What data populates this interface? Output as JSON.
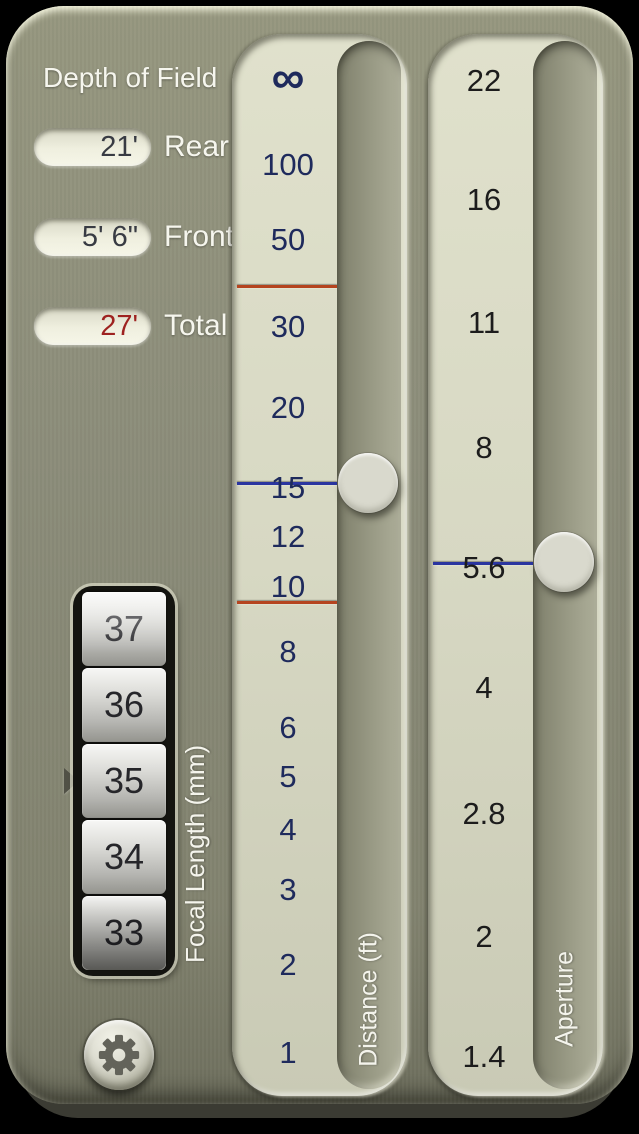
{
  "app": {
    "title": "Depth of Field"
  },
  "readouts": {
    "rear": {
      "value": "21'",
      "label": "Rear"
    },
    "front": {
      "value": "5' 6\"",
      "label": "Front"
    },
    "total": {
      "value": "27'",
      "label": "Total"
    }
  },
  "focal_picker": {
    "label": "Focal Length (mm)",
    "selected": "35",
    "values": [
      {
        "text": "37"
      },
      {
        "text": "36"
      },
      {
        "text": "35"
      },
      {
        "text": "34"
      },
      {
        "text": "33"
      }
    ]
  },
  "distance_slider": {
    "label": "Distance (ft)",
    "ticks": [
      {
        "text": "∞",
        "y": 43,
        "cls": "inf"
      },
      {
        "text": "100",
        "y": 131
      },
      {
        "text": "50",
        "y": 206
      },
      {
        "text": "30",
        "y": 293
      },
      {
        "text": "20",
        "y": 374
      },
      {
        "text": "15",
        "y": 454
      },
      {
        "text": "12",
        "y": 503
      },
      {
        "text": "10",
        "y": 553
      },
      {
        "text": "8",
        "y": 618
      },
      {
        "text": "6",
        "y": 694
      },
      {
        "text": "5",
        "y": 743
      },
      {
        "text": "4",
        "y": 796
      },
      {
        "text": "3",
        "y": 856
      },
      {
        "text": "2",
        "y": 931
      },
      {
        "text": "1",
        "y": 1019
      }
    ],
    "markers": [
      {
        "y": 251,
        "cls": "red"
      },
      {
        "y": 448,
        "cls": "blue"
      },
      {
        "y": 567,
        "cls": "red"
      }
    ],
    "knob_top": 419
  },
  "aperture_slider": {
    "label": "Aperture",
    "ticks": [
      {
        "text": "22",
        "y": 47
      },
      {
        "text": "16",
        "y": 166
      },
      {
        "text": "11",
        "y": 289
      },
      {
        "text": "8",
        "y": 414
      },
      {
        "text": "5.6",
        "y": 534
      },
      {
        "text": "4",
        "y": 654
      },
      {
        "text": "2.8",
        "y": 780
      },
      {
        "text": "2",
        "y": 903
      },
      {
        "text": "1.4",
        "y": 1023
      }
    ],
    "markers": [
      {
        "y": 528,
        "cls": "blue"
      }
    ],
    "knob_top": 498
  },
  "colors": {
    "dof_limit_marker": "#b5441f",
    "focus_marker": "#2a35a0",
    "distance_tick_text": "#1e2a5c",
    "aperture_tick_text": "#1c1c1c",
    "total_value_red": "#9e2220",
    "panel_olive": "#8c8d7a",
    "scale_cream": "#d7d8c3"
  }
}
